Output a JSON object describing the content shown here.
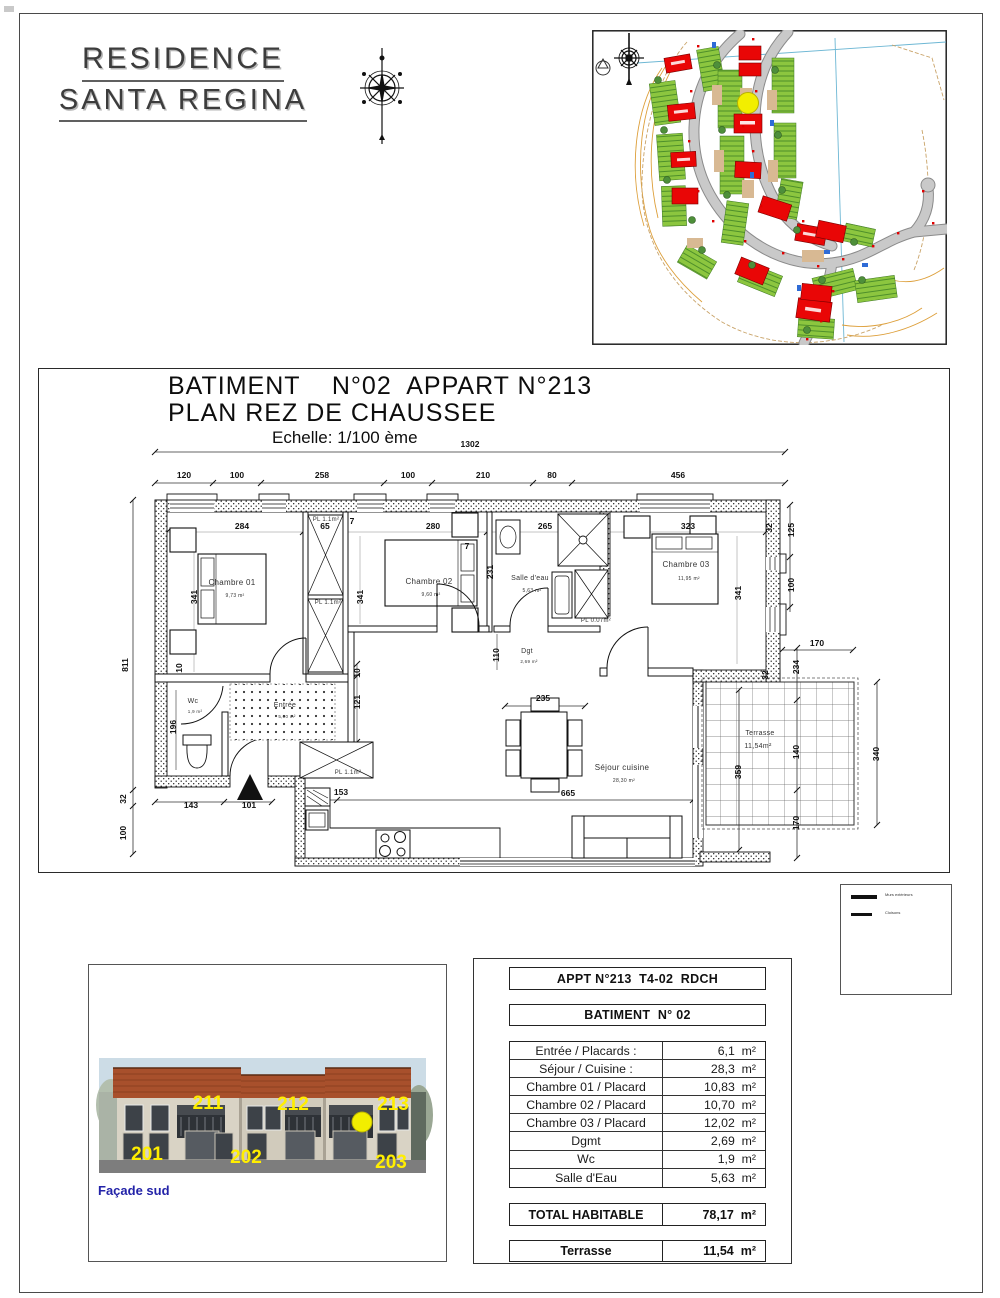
{
  "brand": {
    "line1": "RESIDENCE",
    "line2": "SANTA REGINA"
  },
  "plan": {
    "title": "BATIMENT    N°02  APPART N°213",
    "subtitle": "PLAN REZ DE CHAUSSEE",
    "scale": "Echelle: 1/100 ème",
    "dim_labels": [
      {
        "t": "1302",
        "x": 470,
        "y": 447
      },
      {
        "t": "120",
        "x": 184,
        "y": 478
      },
      {
        "t": "100",
        "x": 237,
        "y": 478
      },
      {
        "t": "258",
        "x": 322,
        "y": 478
      },
      {
        "t": "100",
        "x": 408,
        "y": 478
      },
      {
        "t": "210",
        "x": 483,
        "y": 478
      },
      {
        "t": "80",
        "x": 552,
        "y": 478
      },
      {
        "t": "456",
        "x": 678,
        "y": 478
      },
      {
        "t": "284",
        "x": 242,
        "y": 529
      },
      {
        "t": "65",
        "x": 325,
        "y": 529
      },
      {
        "t": "7",
        "x": 352,
        "y": 524
      },
      {
        "t": "280",
        "x": 433,
        "y": 529
      },
      {
        "t": "265",
        "x": 545,
        "y": 529
      },
      {
        "t": "323",
        "x": 688,
        "y": 529
      },
      {
        "t": "7",
        "x": 467,
        "y": 549
      },
      {
        "t": "811",
        "x": 128,
        "y": 665,
        "r": -90
      },
      {
        "t": "32",
        "x": 126,
        "y": 799,
        "r": -90
      },
      {
        "t": "100",
        "x": 126,
        "y": 833,
        "r": -90
      },
      {
        "t": "341",
        "x": 197,
        "y": 597,
        "r": -90
      },
      {
        "t": "341",
        "x": 363,
        "y": 597,
        "r": -90
      },
      {
        "t": "341",
        "x": 741,
        "y": 593,
        "r": -90
      },
      {
        "t": "231",
        "x": 493,
        "y": 572,
        "r": -90
      },
      {
        "t": "32",
        "x": 772,
        "y": 528,
        "r": -90
      },
      {
        "t": "32",
        "x": 768,
        "y": 675,
        "r": -90
      },
      {
        "t": "125",
        "x": 794,
        "y": 530,
        "r": -90
      },
      {
        "t": "100",
        "x": 794,
        "y": 585,
        "r": -90
      },
      {
        "t": "10",
        "x": 182,
        "y": 668,
        "r": -90
      },
      {
        "t": "196",
        "x": 176,
        "y": 727,
        "r": -90
      },
      {
        "t": "110",
        "x": 499,
        "y": 655,
        "r": -90
      },
      {
        "t": "10",
        "x": 360,
        "y": 673,
        "r": -90
      },
      {
        "t": "121",
        "x": 360,
        "y": 702,
        "r": -90
      },
      {
        "t": "143",
        "x": 191,
        "y": 808
      },
      {
        "t": "101",
        "x": 249,
        "y": 808
      },
      {
        "t": "153",
        "x": 341,
        "y": 795
      },
      {
        "t": "235",
        "x": 543,
        "y": 701
      },
      {
        "t": "665",
        "x": 568,
        "y": 796
      },
      {
        "t": "170",
        "x": 817,
        "y": 646
      },
      {
        "t": "234",
        "x": 799,
        "y": 667,
        "r": -90
      },
      {
        "t": "140",
        "x": 799,
        "y": 752,
        "r": -90
      },
      {
        "t": "170",
        "x": 799,
        "y": 823,
        "r": -90
      },
      {
        "t": "340",
        "x": 879,
        "y": 754,
        "r": -90
      },
      {
        "t": "359",
        "x": 741,
        "y": 772,
        "r": -90
      }
    ],
    "room_labels": [
      {
        "t": "Chambre 01",
        "x": 232,
        "y": 585,
        "s": 8
      },
      {
        "t": "9,73 m²",
        "x": 235,
        "y": 597,
        "s": 5
      },
      {
        "t": "Chambre 02",
        "x": 429,
        "y": 584,
        "s": 8
      },
      {
        "t": "9,60 m²",
        "x": 431,
        "y": 596,
        "s": 5
      },
      {
        "t": "Chambre 03",
        "x": 686,
        "y": 567,
        "s": 8
      },
      {
        "t": "11,95 m²",
        "x": 689,
        "y": 580,
        "s": 5
      },
      {
        "t": "Salle d'eau",
        "x": 530,
        "y": 580,
        "s": 7
      },
      {
        "t": "5,63 m²",
        "x": 532,
        "y": 592,
        "s": 5
      },
      {
        "t": "Wc",
        "x": 193,
        "y": 703,
        "s": 7
      },
      {
        "t": "1,9 m²",
        "x": 195,
        "y": 713,
        "s": 4.5
      },
      {
        "t": "Entrée",
        "x": 285,
        "y": 707,
        "s": 7
      },
      {
        "t": "5,00 m²",
        "x": 287,
        "y": 718,
        "s": 4.5
      },
      {
        "t": "Dgt",
        "x": 527,
        "y": 653,
        "s": 7
      },
      {
        "t": "2,69 m²",
        "x": 529,
        "y": 663,
        "s": 4.5
      },
      {
        "t": "Séjour cuisine",
        "x": 622,
        "y": 770,
        "s": 8
      },
      {
        "t": "28,30 m²",
        "x": 624,
        "y": 782,
        "s": 5
      },
      {
        "t": "Terrasse",
        "x": 760,
        "y": 735,
        "s": 7
      },
      {
        "t": "11,54m²",
        "x": 758,
        "y": 748,
        "s": 7
      },
      {
        "t": "PL 1.1m²",
        "x": 326,
        "y": 521,
        "s": 6
      },
      {
        "t": "PL 1.1m²",
        "x": 328,
        "y": 604,
        "s": 6
      },
      {
        "t": "PL 0.07m²",
        "x": 596,
        "y": 622,
        "s": 6
      },
      {
        "t": "PL 1.1m²",
        "x": 348,
        "y": 774,
        "s": 6
      }
    ]
  },
  "legend": {
    "items": [
      {
        "label": "Murs extérieurs"
      },
      {
        "label": "Cloisons"
      }
    ]
  },
  "facade": {
    "caption": "Façade sud",
    "unit_labels": [
      {
        "t": "211",
        "x": 119,
        "y": 144
      },
      {
        "t": "212",
        "x": 204,
        "y": 145
      },
      {
        "t": "213",
        "x": 304,
        "y": 145
      },
      {
        "t": "201",
        "x": 58,
        "y": 195
      },
      {
        "t": "202",
        "x": 157,
        "y": 198
      },
      {
        "t": "203",
        "x": 302,
        "y": 203
      }
    ]
  },
  "summary": {
    "header1": "APPT N°213  T4-02  RDCH",
    "header2": "BATIMENT  N° 02",
    "rows": [
      {
        "label": "Entrée / Placards :",
        "value": "6,1  m²"
      },
      {
        "label": "Séjour / Cuisine :",
        "value": "28,3  m²"
      },
      {
        "label": "Chambre 01 / Placard",
        "value": "10,83  m²"
      },
      {
        "label": "Chambre 02 / Placard",
        "value": "10,70  m²"
      },
      {
        "label": "Chambre 03 / Placard",
        "value": "12,02  m²"
      },
      {
        "label": "Dgmt",
        "value": "2,69  m²"
      },
      {
        "label": "Wc",
        "value": "1,9  m²"
      },
      {
        "label": "Salle d'Eau",
        "value": "5,63  m²"
      }
    ],
    "total": {
      "label": "TOTAL HABITABLE",
      "value": "78,17  m²"
    },
    "terrace": {
      "label": "Terrasse",
      "value": "11,54  m²"
    }
  },
  "colors": {
    "highlight_yellow": "#f2ee00",
    "site_building_red": "#e90606",
    "facade_label_yellow": "#ffee00",
    "caption_blue": "#2323a8"
  }
}
